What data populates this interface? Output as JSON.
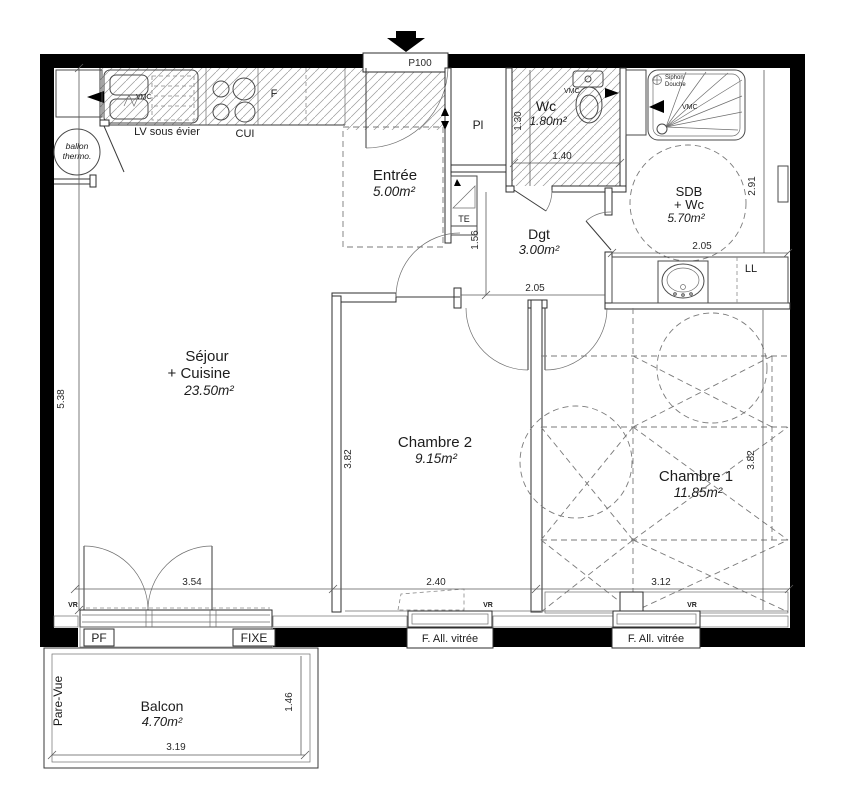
{
  "colors": {
    "wall": "#000000",
    "line": "#3a3a3a",
    "hatch": "#8a8a8a",
    "background": "#ffffff"
  },
  "entrance": {
    "door_code": "P100"
  },
  "rooms": {
    "sejour": {
      "name": "Séjour",
      "name2": "+ Cuisine",
      "area": "23.50m²"
    },
    "entree": {
      "name": "Entrée",
      "area": "5.00m²"
    },
    "wc": {
      "name": "Wc",
      "area": "1.80m²"
    },
    "sdb": {
      "name": "SDB",
      "name2": "+ Wc",
      "area": "5.70m²"
    },
    "dgt": {
      "name": "Dgt",
      "area": "3.00m²"
    },
    "chambre2": {
      "name": "Chambre 2",
      "area": "9.15m²"
    },
    "chambre1": {
      "name": "Chambre 1",
      "area": "11.85m²"
    },
    "balcon": {
      "name": "Balcon",
      "area": "4.70m²"
    }
  },
  "equipment": {
    "vmc": "VMC",
    "lv": "LV sous évier",
    "cui": "CUI",
    "fridge": "F",
    "ballon1": "ballon",
    "ballon2": "thermo.",
    "te": "TE",
    "ll": "LL",
    "pl": "Pl",
    "siphon1": "Siphon",
    "siphon2": "Douche"
  },
  "openings": {
    "pf": "PF",
    "fixe": "FIXE",
    "f_all_vitree": "F. All. vitrée",
    "vr": "VR",
    "pare_vue": "Pare-Vue"
  },
  "dimensions": {
    "sejour_h": "5.38",
    "sejour_w": "3.54",
    "ch2_w": "2.40",
    "ch1_w": "3.12",
    "wc_w": "1.40",
    "wc_h": "1.30",
    "dgt_h": "1.56",
    "dgt_w": "2.05",
    "sdb_w": "2.05",
    "sdb_h": "2.91",
    "ch2_h": "3.82",
    "ch1_h": "3.82",
    "balcon_w": "3.19",
    "balcon_h": "1.46"
  }
}
